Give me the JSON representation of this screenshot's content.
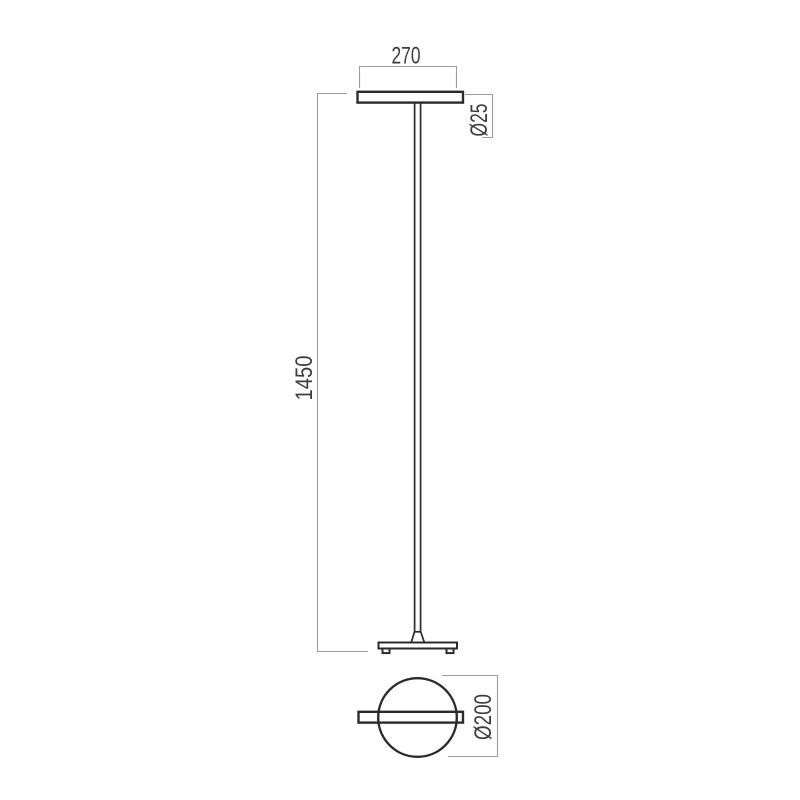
{
  "drawing": {
    "dims": {
      "head_width": "270",
      "pole_diameter": "Ø25",
      "height": "1450",
      "base_diameter": "Ø200"
    },
    "colors": {
      "object_line": "#2b2b2b",
      "dimension_line": "#9b9b9b",
      "text": "#3d3d3d",
      "background": "#ffffff",
      "fill": "#ffffff"
    }
  }
}
